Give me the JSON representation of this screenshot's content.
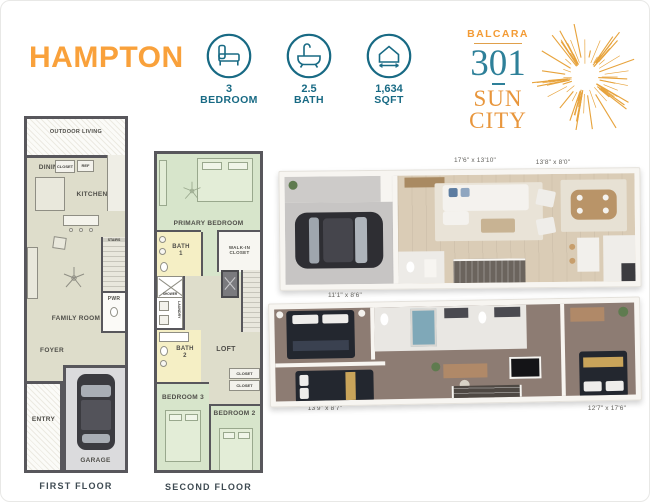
{
  "header": {
    "title": "HAMPTON",
    "stats": [
      {
        "icon": "bed-icon",
        "value": "3",
        "label": "BEDROOM"
      },
      {
        "icon": "bath-icon",
        "value": "2.5",
        "label": "BATH"
      },
      {
        "icon": "sqft-icon",
        "value": "1,634",
        "label": "SQFT"
      }
    ],
    "logo": {
      "brand": "BALCARA",
      "number": "301",
      "city_line1": "SUN",
      "city_line2": "CITY"
    }
  },
  "first_floor": {
    "caption": "FIRST FLOOR",
    "rooms": {
      "outdoor_living": "OUTDOOR LIVING",
      "dining": "DINING",
      "kitchen": "KITCHEN",
      "closet": "CLOSET",
      "ref": "REF",
      "pantry": "PANTRY",
      "stairs": "STAIRS",
      "family_room": "FAMILY ROOM",
      "pwr": "PWR",
      "foyer": "FOYER",
      "entry": "ENTRY",
      "garage": "GARAGE"
    }
  },
  "second_floor": {
    "caption": "SECOND FLOOR",
    "rooms": {
      "primary_bedroom": "PRIMARY BEDROOM",
      "bath_1": "BATH\n1",
      "walk_in_closet": "WALK-IN\nCLOSET",
      "shower": "SHOWER",
      "laundry": "LAUNDRY",
      "loft": "LOFT",
      "bath_2": "BATH\n2",
      "closet_upper": "CLOSET",
      "closet_lower": "CLOSET",
      "bedroom_3": "BEDROOM 3",
      "bedroom_2": "BEDROOM 2"
    }
  },
  "render_first_floor": {
    "dimensions": [
      "17'6\" x 13'10\"",
      "13'8\" x 8'0\""
    ]
  },
  "render_second_floor": {
    "dimensions": [
      "11'1\" x 8'6\"",
      "13'9\" x 8'7\"",
      "12'7\" x 17'6\""
    ]
  },
  "colors": {
    "accent_orange": "#F9A13B",
    "teal": "#186A84",
    "logo_teal": "#2E8099",
    "sunburst_gold": "#E7A33C",
    "plan_beige": "#DEDDCB",
    "plan_green": "#D7E5CB",
    "plan_yellow": "#F5EFC5",
    "plan_gray": "#DBDBDD",
    "wall": "#58575C"
  }
}
